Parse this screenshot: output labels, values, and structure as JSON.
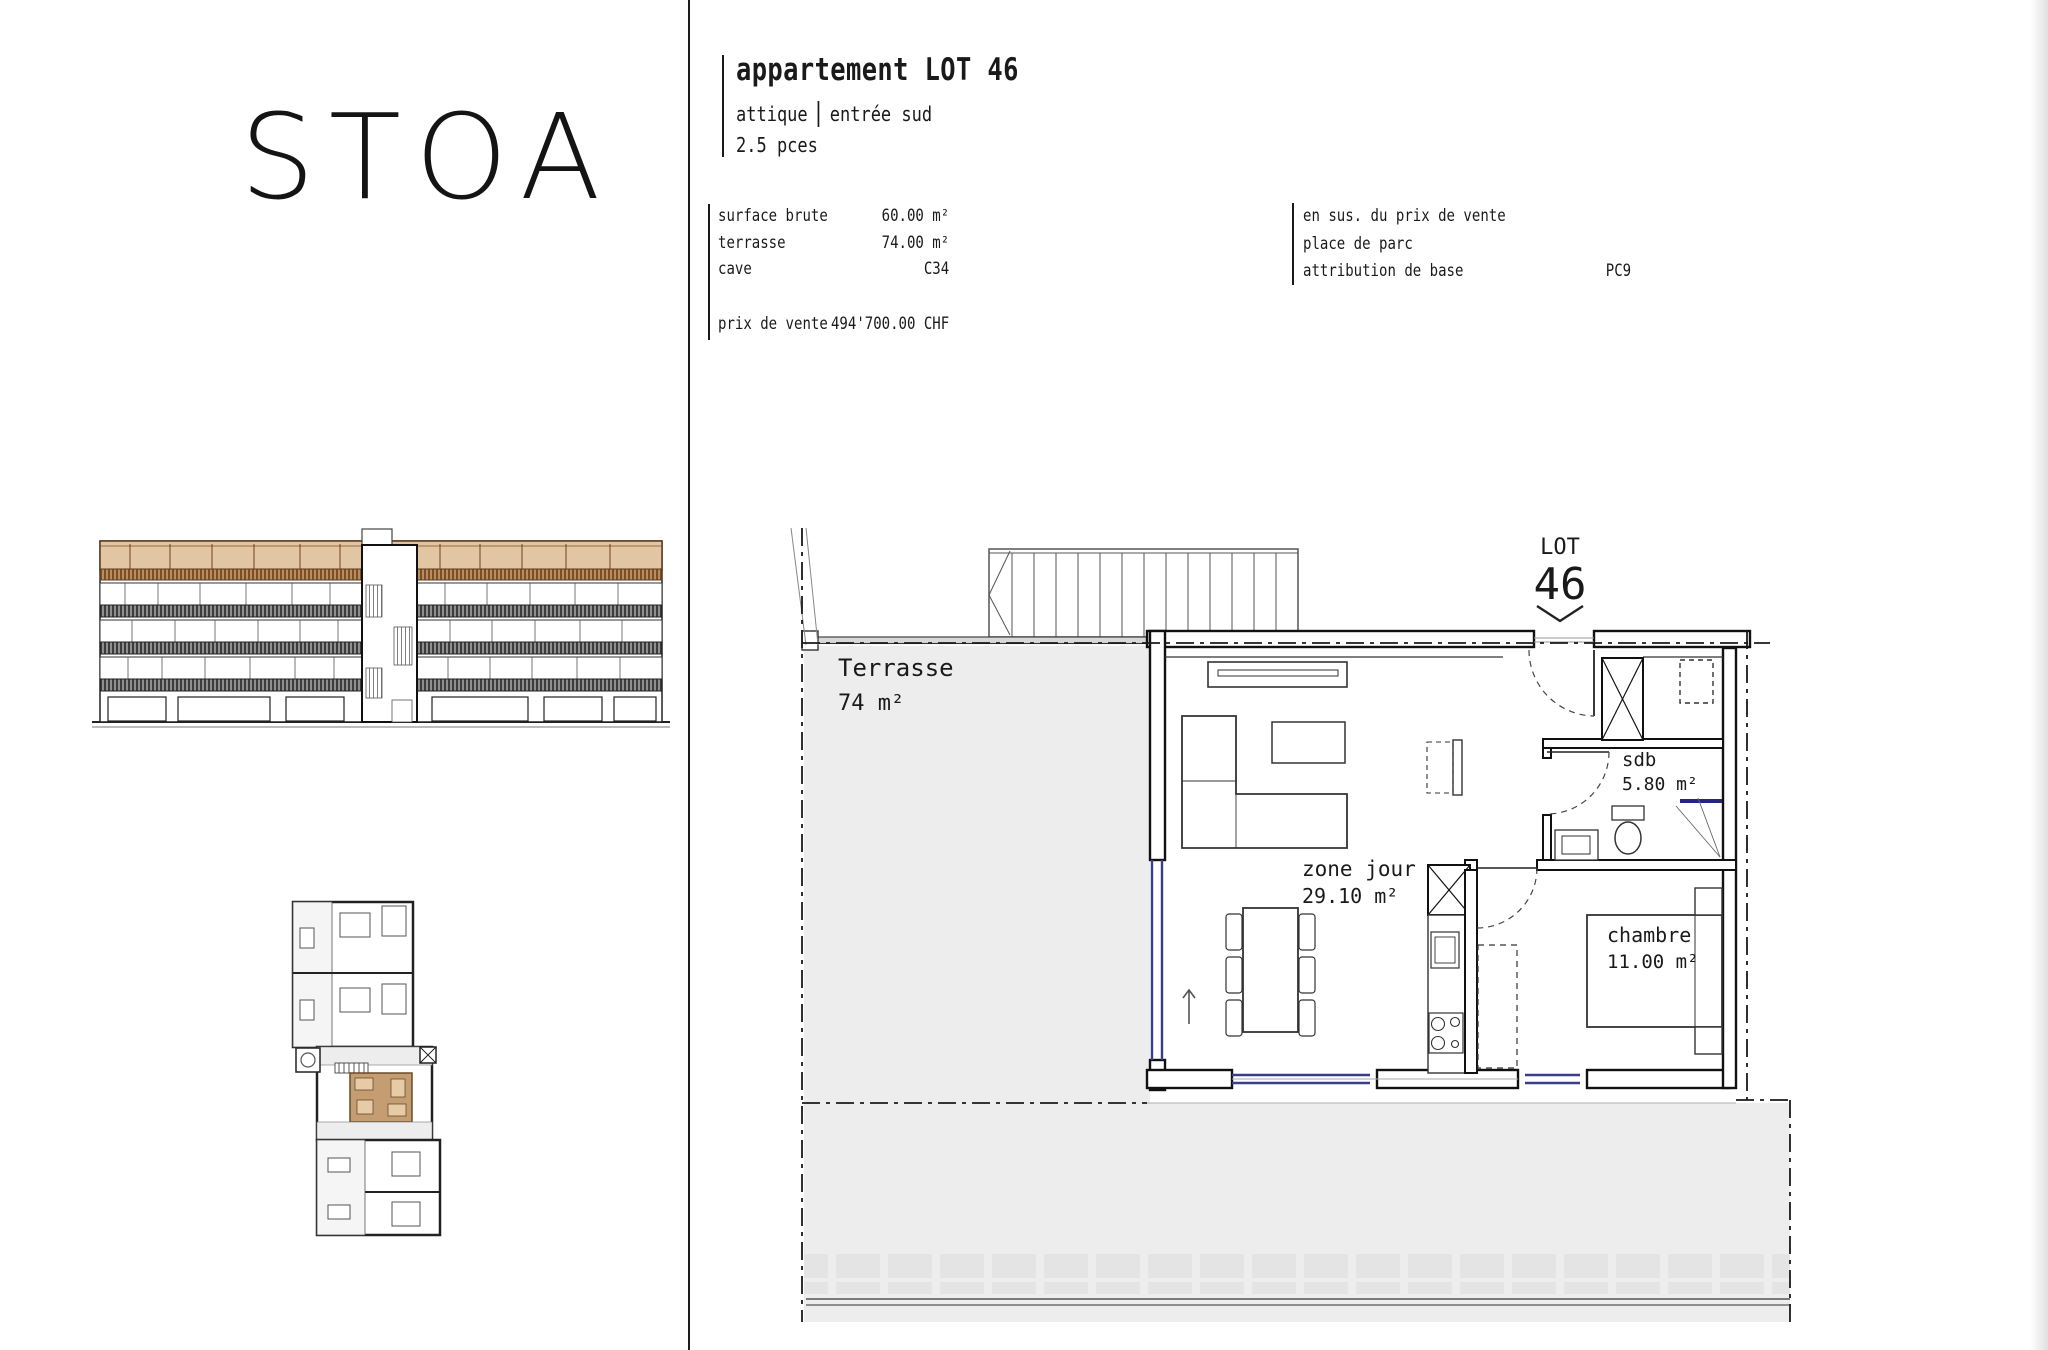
{
  "brand": {
    "logo": "STOA"
  },
  "header": {
    "title": "appartement LOT 46",
    "floor": "attique",
    "entrance": "entrée sud",
    "rooms": "2.5 pces"
  },
  "specs": {
    "rows": [
      {
        "label": "surface brute",
        "value": "60.00 m²"
      },
      {
        "label": "terrasse",
        "value": "74.00 m²"
      },
      {
        "label": "cave",
        "value": "C34"
      }
    ],
    "price_label": "prix de vente",
    "price_value": "494'700.00 CHF"
  },
  "extras": {
    "title": "en sus. du prix de vente",
    "item": "place de parc",
    "attribution_label": "attribution de base",
    "attribution_value": "PC9"
  },
  "plan": {
    "lot_tag": "LOT",
    "lot_number": "46",
    "labels": {
      "terrasse": {
        "name": "Terrasse",
        "area": "74 m²"
      },
      "zone_jour": {
        "name": "zone jour",
        "area": "29.10 m²"
      },
      "sdb": {
        "name": "sdb",
        "area": "5.80 m²"
      },
      "chambre": {
        "name": "chambre",
        "area": "11.00 m²"
      }
    }
  },
  "colors": {
    "attic_fill": "#e2c5a2",
    "attic_line": "#5a3a1e",
    "highlight_unit": "#c49d72",
    "plan_gray": "#ededed",
    "window_blue": "#3b3b8f",
    "ink": "#1a1a1a"
  }
}
